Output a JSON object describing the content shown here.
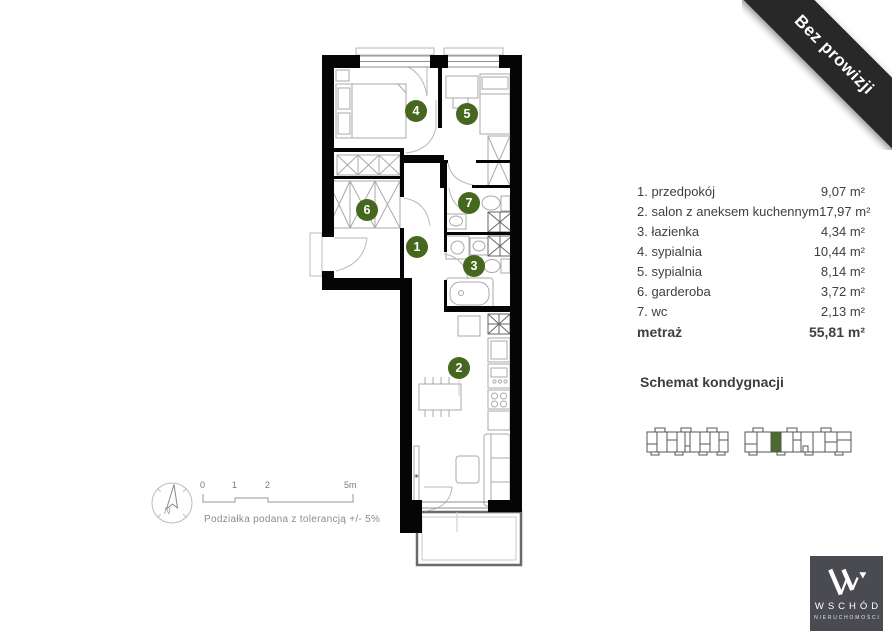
{
  "ribbon": {
    "label": "Bez prowizji"
  },
  "legend": {
    "rooms": [
      {
        "number": "1",
        "label": "1. przedpokój",
        "area": "9,07 m²"
      },
      {
        "number": "2",
        "label": "2. salon z aneksem kuchennym",
        "area": "17,97 m²"
      },
      {
        "number": "3",
        "label": "3. łazienka",
        "area": "4,34 m²"
      },
      {
        "number": "4",
        "label": "4. sypialnia",
        "area": "10,44 m²"
      },
      {
        "number": "5",
        "label": "5. sypialnia",
        "area": "8,14 m²"
      },
      {
        "number": "6",
        "label": "6. garderoba",
        "area": "3,72 m²"
      },
      {
        "number": "7",
        "label": "7. wc",
        "area": "2,13 m²"
      }
    ],
    "total_label": "metraż",
    "total_area": "55,81 m²"
  },
  "floor_schematic": {
    "title": "Schemat kondygnacji"
  },
  "scale_bar": {
    "ticks": [
      "0",
      "1",
      "2",
      "5m"
    ],
    "tolerance_note": "Podziałka podana z tolerancją +/- 5%"
  },
  "compass": {
    "north_label": "N"
  },
  "logo": {
    "title": "WSCHÓD",
    "subtitle": "NIERUCHOMOŚCI"
  },
  "colors": {
    "badge_green": "#45671e",
    "highlighted_unit_green": "#4d6b2d",
    "ribbon_bg": "#282828",
    "logo_bg": "#4a4a51",
    "wall_black": "#050505"
  }
}
